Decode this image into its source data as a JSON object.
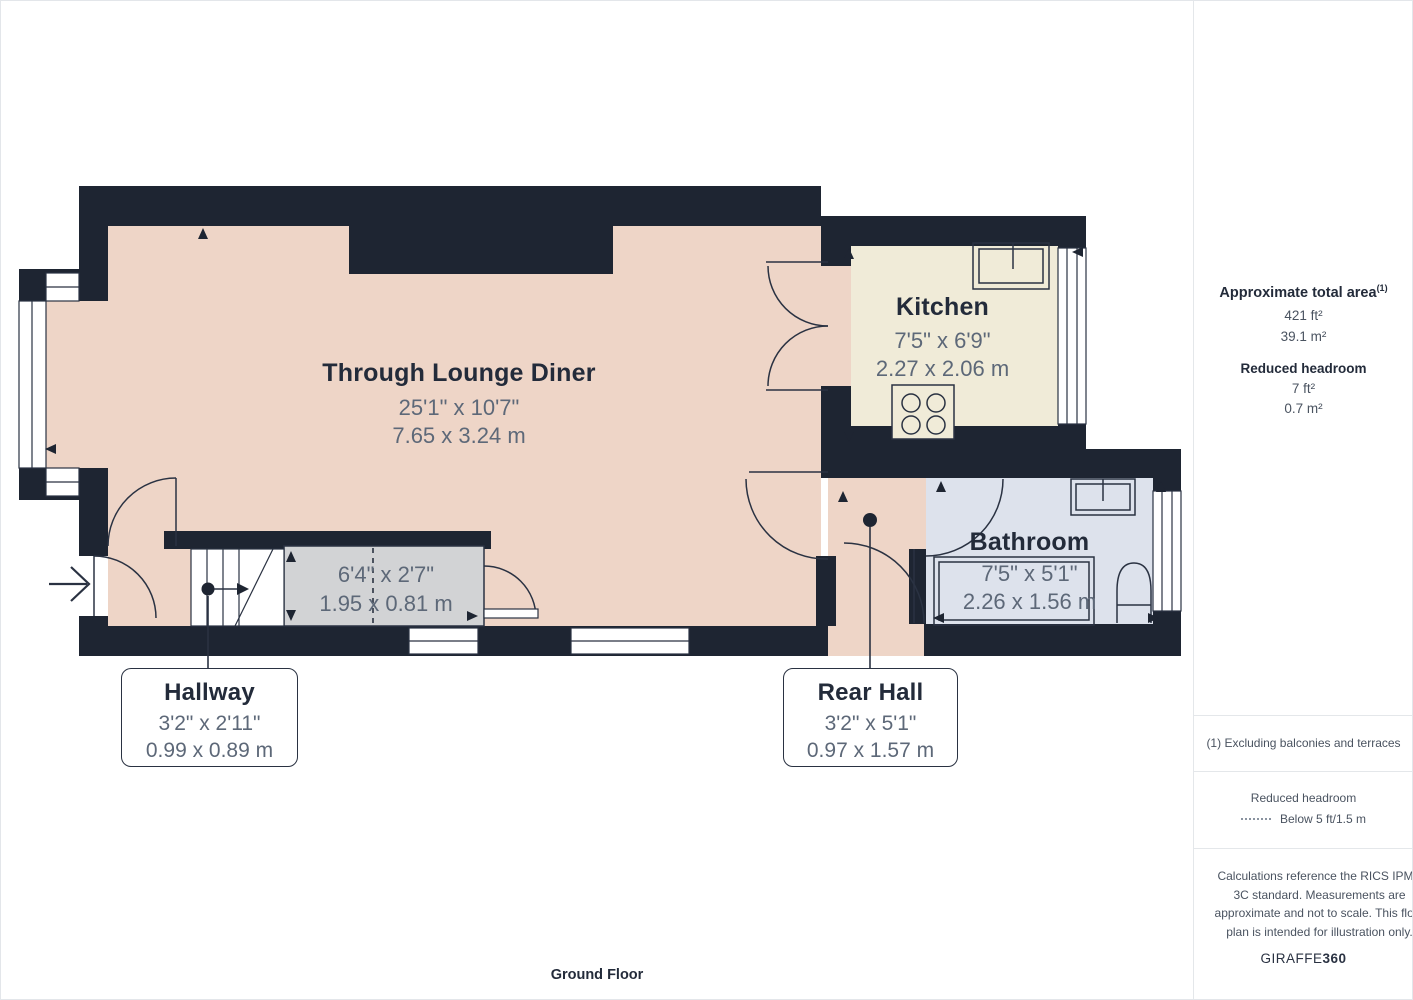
{
  "floor_label": "Ground Floor",
  "rooms": {
    "lounge": {
      "name": "Through Lounge Diner",
      "ft": "25'1\" x 10'7\"",
      "m": "7.65 x 3.24 m"
    },
    "kitchen": {
      "name": "Kitchen",
      "ft": "7'5\" x 6'9\"",
      "m": "2.27 x 2.06 m"
    },
    "bathroom": {
      "name": "Bathroom",
      "ft": "7'5\" x 5'1\"",
      "m": "2.26 x 1.56 m"
    },
    "storage": {
      "ft": "6'4\" x 2'7\"",
      "m": "1.95 x 0.81 m"
    },
    "hallway": {
      "name": "Hallway",
      "ft": "3'2\" x 2'11\"",
      "m": "0.99 x 0.89 m"
    },
    "rear_hall": {
      "name": "Rear Hall",
      "ft": "3'2\" x 5'1\"",
      "m": "0.97 x 1.57 m"
    }
  },
  "sidebar": {
    "total_area_heading": "Approximate total area",
    "total_area_sup": "(1)",
    "total_area_ft": "421 ft²",
    "total_area_m": "39.1 m²",
    "reduced_heading": "Reduced headroom",
    "reduced_ft": "7 ft²",
    "reduced_m": "0.7 m²",
    "footnote": "(1) Excluding balconies and terraces",
    "legend_heading": "Reduced headroom",
    "legend_label": "Below 5 ft/1.5 m",
    "disclaimer": "Calculations reference the RICS IPMS 3C standard. Measurements are approximate and not to scale. This floor plan is intended for illustration only.",
    "brand_left": "GIRAFFE",
    "brand_right": "360"
  },
  "colors": {
    "wall": "#1e2532",
    "room_peach": "#eed5c7",
    "room_cream": "#f0ebd8",
    "room_blue": "#dde2ec",
    "room_gray": "#d2d3d5",
    "label": "#232b3a",
    "dims": "#5d6878"
  }
}
